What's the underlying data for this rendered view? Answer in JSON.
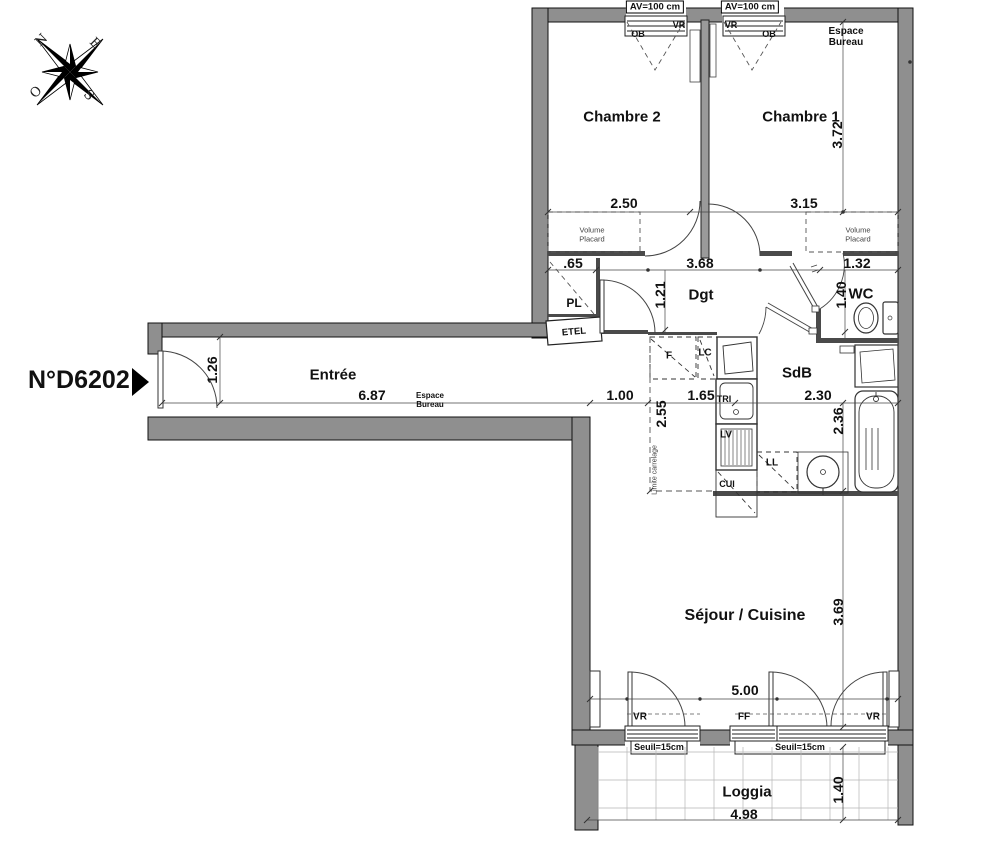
{
  "plan": {
    "unit": "N°D6202",
    "compass": {
      "n": "N",
      "e": "E",
      "s": "S",
      "o": "O"
    },
    "rooms": {
      "chambre2": "Chambre 2",
      "chambre1": "Chambre 1",
      "dgt": "Dgt",
      "wc": "WC",
      "pl": "PL",
      "etel": "ETEL",
      "entree": "Entrée",
      "sdb": "SdB",
      "sejour": "Séjour / Cuisine",
      "loggia": "Loggia"
    },
    "annotations": {
      "espace_bureau": "Espace Bureau",
      "volume_placard": "Volume Placard",
      "limite_carrelage": "Limite carrelage",
      "av": "AV=100 cm",
      "vr": "VR",
      "ob": "OB",
      "ff": "FF",
      "seuil": "Seuil=15cm",
      "f": "F",
      "lc": "LC",
      "tri": "TRI",
      "lv": "LV",
      "cui": "CUI",
      "ll": "LL"
    },
    "dims": {
      "chambre2_w": "2.50",
      "chambre1_w": "3.15",
      "chambre1_h": "3.72",
      "dgt_w": "3.68",
      "wc_w": "1.32",
      "pl_w": ".65",
      "dgt_h": "1.21",
      "wc_h": "1.40",
      "entree_h": "1.26",
      "entree_w": "6.87",
      "gap_w": "1.00",
      "cuisine_w": "1.65",
      "sdb_w": "2.30",
      "cuisine_h": "2.55",
      "sdb_h": "2.36",
      "sejour_h": "3.69",
      "sejour_w": "5.00",
      "loggia_w": "4.98",
      "loggia_h": "1.40"
    }
  }
}
